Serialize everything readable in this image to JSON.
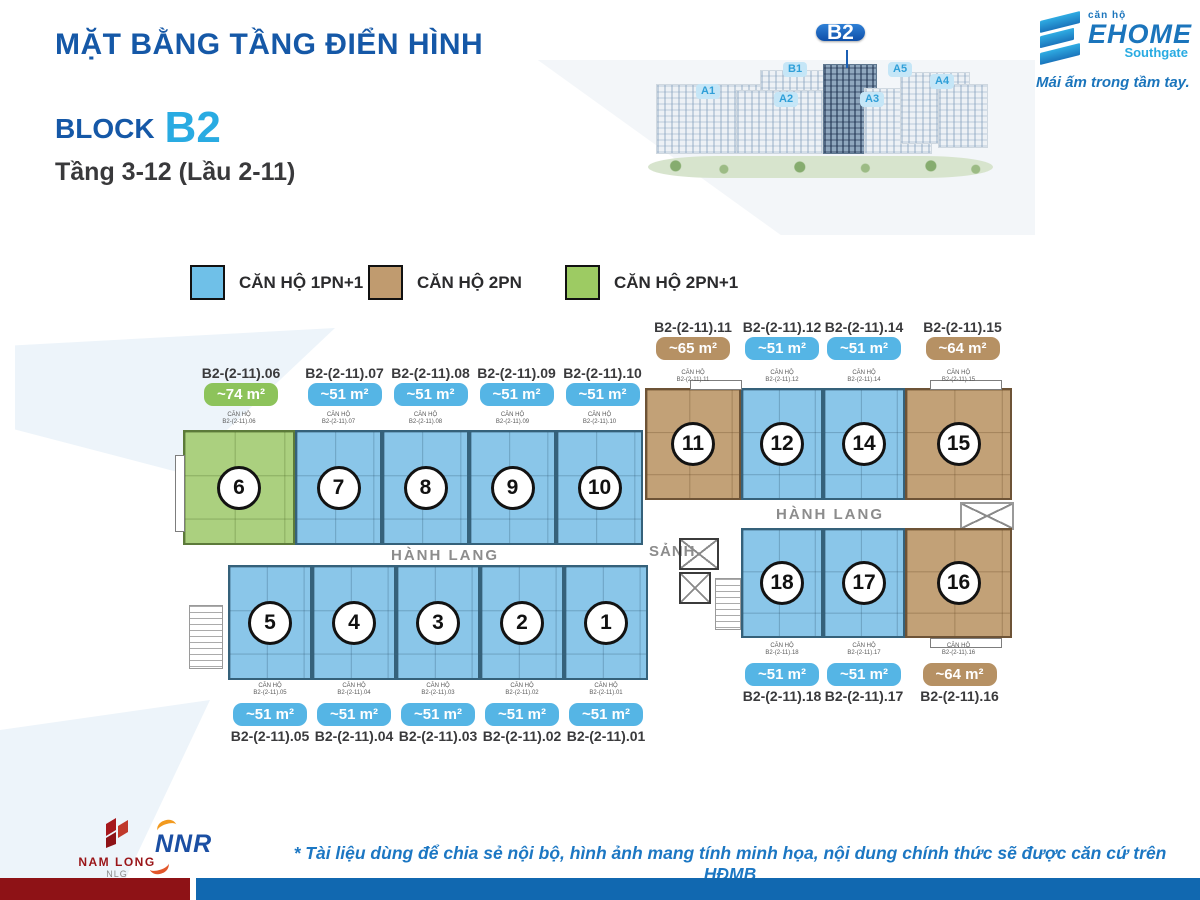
{
  "page": {
    "title": "MẶT BẰNG TẦNG ĐIỂN HÌNH",
    "block_label": "BLOCK",
    "block_value": "B2",
    "floor_range": "Tầng 3-12 (Lầu 2-11)"
  },
  "logo": {
    "prefix": "căn hộ",
    "name": "EHOME",
    "sub": "Southgate",
    "tagline": "Mái ấm trong tầm tay."
  },
  "site_map": {
    "towers": [
      {
        "label": "A1"
      },
      {
        "label": "B1"
      },
      {
        "label": "A2"
      },
      {
        "label": "B2",
        "highlight": true
      },
      {
        "label": "A3"
      },
      {
        "label": "A5"
      },
      {
        "label": "A4"
      }
    ]
  },
  "legend": [
    {
      "label": "CĂN HỘ 1PN+1",
      "color": "#8AC6E9"
    },
    {
      "label": "CĂN HỘ 2PN",
      "color": "#C2A177"
    },
    {
      "label": "CĂN HỘ 2PN+1",
      "color": "#ABD07F"
    }
  ],
  "labels": {
    "can_ho": "CĂN HỘ",
    "corridor": "HÀNH LANG",
    "lobby": "SẢNH"
  },
  "units": {
    "u01": {
      "code": "B2-(2-11).01",
      "number": "1",
      "area": "~51 m²",
      "type": "1PN+1"
    },
    "u02": {
      "code": "B2-(2-11).02",
      "number": "2",
      "area": "~51 m²",
      "type": "1PN+1"
    },
    "u03": {
      "code": "B2-(2-11).03",
      "number": "3",
      "area": "~51 m²",
      "type": "1PN+1"
    },
    "u04": {
      "code": "B2-(2-11).04",
      "number": "4",
      "area": "~51 m²",
      "type": "1PN+1"
    },
    "u05": {
      "code": "B2-(2-11).05",
      "number": "5",
      "area": "~51 m²",
      "type": "1PN+1"
    },
    "u06": {
      "code": "B2-(2-11).06",
      "number": "6",
      "area": "~74 m²",
      "type": "2PN+1"
    },
    "u07": {
      "code": "B2-(2-11).07",
      "number": "7",
      "area": "~51 m²",
      "type": "1PN+1"
    },
    "u08": {
      "code": "B2-(2-11).08",
      "number": "8",
      "area": "~51 m²",
      "type": "1PN+1"
    },
    "u09": {
      "code": "B2-(2-11).09",
      "number": "9",
      "area": "~51 m²",
      "type": "1PN+1"
    },
    "u10": {
      "code": "B2-(2-11).10",
      "number": "10",
      "area": "~51 m²",
      "type": "1PN+1"
    },
    "u11": {
      "code": "B2-(2-11).11",
      "number": "11",
      "area": "~65 m²",
      "type": "2PN"
    },
    "u12": {
      "code": "B2-(2-11).12",
      "number": "12",
      "area": "~51 m²",
      "type": "1PN+1"
    },
    "u14": {
      "code": "B2-(2-11).14",
      "number": "14",
      "area": "~51 m²",
      "type": "1PN+1"
    },
    "u15": {
      "code": "B2-(2-11).15",
      "number": "15",
      "area": "~64 m²",
      "type": "2PN"
    },
    "u16": {
      "code": "B2-(2-11).16",
      "number": "16",
      "area": "~64 m²",
      "type": "2PN"
    },
    "u17": {
      "code": "B2-(2-11).17",
      "number": "17",
      "area": "~51 m²",
      "type": "1PN+1"
    },
    "u18": {
      "code": "B2-(2-11).18",
      "number": "18",
      "area": "~51 m²",
      "type": "1PN+1"
    }
  },
  "footer": {
    "namlong": "NAM LONG",
    "nlg": "NLG",
    "nnr": "NNR",
    "disclaimer": "* Tài liệu dùng để chia sẻ nội bộ, hình ảnh mang tính minh họa, nội dung chính thức sẽ được căn cứ trên HĐMB"
  }
}
